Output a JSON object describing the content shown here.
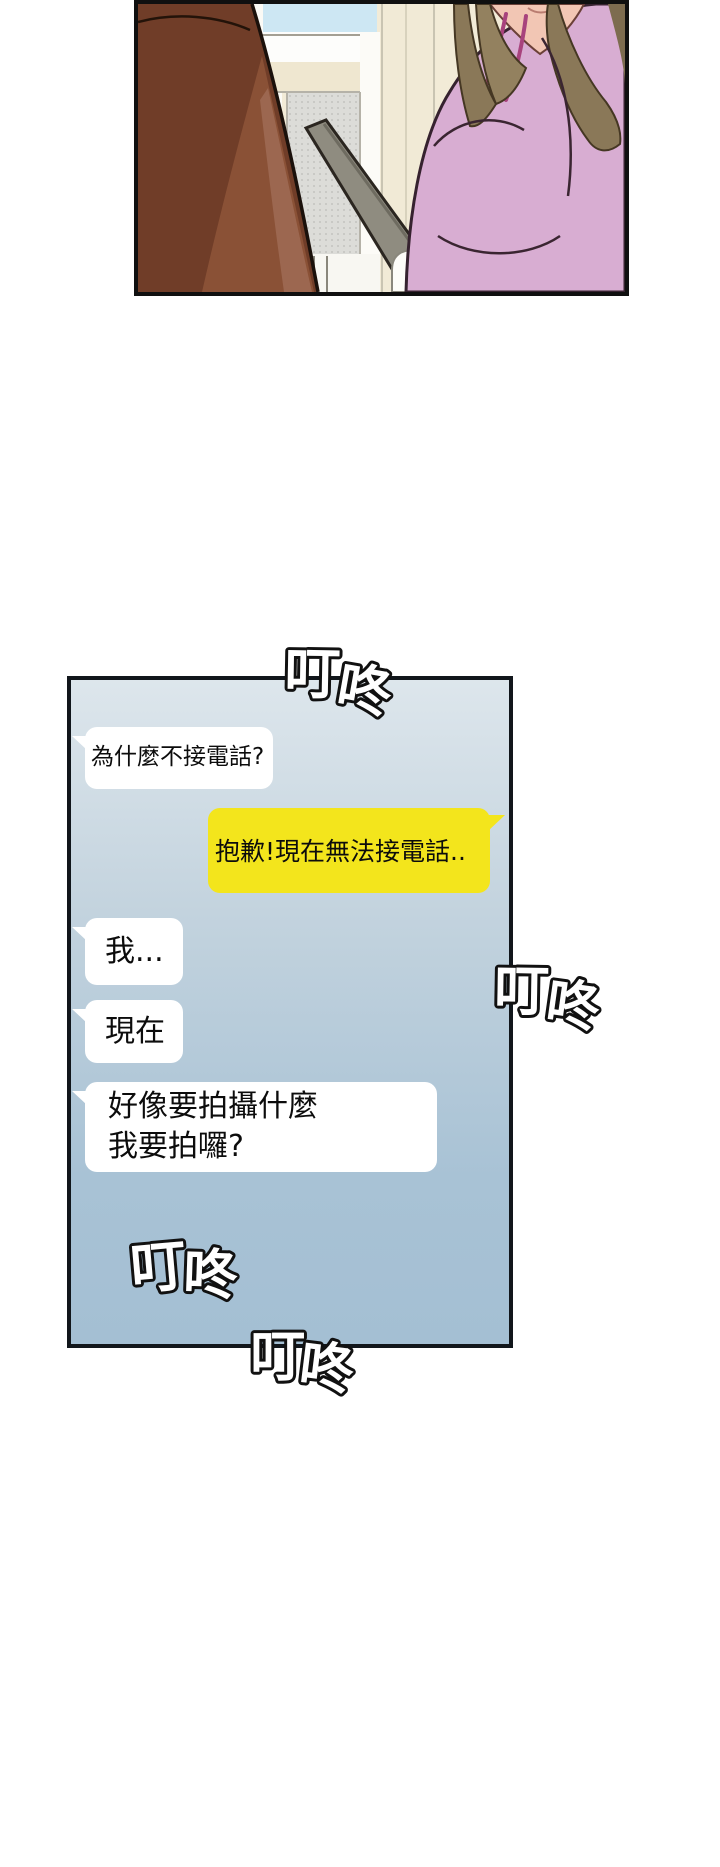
{
  "page": {
    "kind": "comic page",
    "background": "#ffffff",
    "width": 720,
    "height": 1867
  },
  "scene": {
    "palette": {
      "wall": "#f2ebd7",
      "sky": "#cde7f3",
      "window_white": "#fdfdfb",
      "window_cream": "#efe7d0",
      "screen": "#dcdcd8",
      "railing": "#8f8c80",
      "figure": "#703d28",
      "figure_light": "#8a5136",
      "figure_lighter": "#9c6750",
      "sweater": "#d8add2",
      "hair": "#8a7858",
      "skin": "#f2c6b4",
      "cord": "#a8437d"
    }
  },
  "chat": {
    "panel_border": "#11161b",
    "background_top": "#dde6ec",
    "background_bottom": "#a4bfd3",
    "messages": [
      {
        "sender": "left",
        "bubble": "#ffffff",
        "text": "為什麼不接電話?"
      },
      {
        "sender": "right",
        "bubble": "#f3e51c",
        "text": "抱歉!現在無法接電話.."
      },
      {
        "sender": "left",
        "bubble": "#ffffff",
        "text": "我..."
      },
      {
        "sender": "left",
        "bubble": "#ffffff",
        "text": "現在"
      },
      {
        "sender": "left",
        "bubble": "#ffffff",
        "text": "好像要拍攝什麼\n我要拍囉?"
      }
    ]
  },
  "sfx": {
    "text": "叮咚",
    "char1": "叮",
    "char2": "咚",
    "occurrences": 4,
    "fill": "#ffffff",
    "outline": "#111111"
  }
}
